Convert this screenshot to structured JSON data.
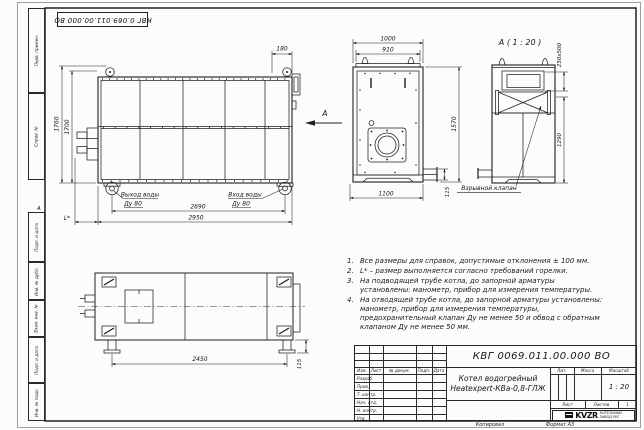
{
  "frame": {
    "top_designation": "КВГ 0.069.011.00.000 ВО",
    "zone_mark": "А",
    "copied": "Копировал",
    "format": "Формат А3",
    "cols": {
      "perv": "Перв. примен.",
      "sprav": "Справ. №",
      "podp1": "Подп. и дата",
      "inv_dubl": "Инв. № дубл.",
      "vzam": "Взам. инв. №",
      "podp2": "Подп. и дата",
      "inv_podl": "Инв. № подл."
    }
  },
  "views": {
    "main": {
      "dim_height_outer": "1760",
      "dim_height_inner": "1700",
      "dim_top": "180",
      "dim_width_inner": "2690",
      "dim_width_outer": "2950",
      "dim_burner": "L*",
      "outlet_label": "Выход воды",
      "outlet_dn": "Ду 80",
      "inlet_label": "Вход воды",
      "inlet_dn": "Ду 80"
    },
    "arrow_label": "А",
    "front": {
      "dim_top_outer": "1000",
      "dim_top_inner": "910",
      "dim_height": "1570",
      "dim_bottom": "1100",
      "dim_valve": "115"
    },
    "detail": {
      "title": "А ( 1 : 20 )",
      "dim_flue": "250х500",
      "dim_height": "1290",
      "explosion_label": "Взрывной клапан"
    },
    "plan": {
      "dim_feet": "2450",
      "dim_foot_height": "115"
    }
  },
  "notes": {
    "items": [
      {
        "num": "1.",
        "text": "Все размеры для справок, допустимые отклонения ± 100 мм."
      },
      {
        "num": "2.",
        "text": "L* – размер выполняется согласно требований горелки."
      },
      {
        "num": "3.",
        "text": "На подводящей трубе котла, до запорной арматуры установлены: манометр, прибор для измерения температуры."
      },
      {
        "num": "4.",
        "text": "На отводящей трубе котла, до запорной арматуры установлены: манометр, прибор для измерения температуры, предохранительный клапан Ду не менее 50 и обвод с обратным клапаном Ду не менее 50 мм."
      }
    ]
  },
  "title_block": {
    "designation": "КВГ 0069.011.00.000 ВО",
    "name_line1": "Котел водогрейный",
    "name_line2": "Heatexpert-КВа-0,8-ГЛЖ",
    "col_izm": "Изм.",
    "col_list": "Лист",
    "col_ndok": "№ докум.",
    "col_podp": "Подп.",
    "col_data": "Дата",
    "row_razrab": "Разраб.",
    "row_prov": "Пров.",
    "row_tkontr": "Т. контр.",
    "row_nachotd": "Нач. отд.",
    "row_nkontr": "Н. контр.",
    "row_utv": "Утв.",
    "lit": "Лит.",
    "massa": "Масса",
    "masshtab": "Масштаб",
    "scale_value": "1 : 20",
    "list_label": "Лист",
    "listov_label": "Листов",
    "listov_value": "1",
    "logo": "KVZR",
    "company_line1": "КОТЕЛЬНЫЙ",
    "company_line2": "ЗАВОД РУС"
  }
}
